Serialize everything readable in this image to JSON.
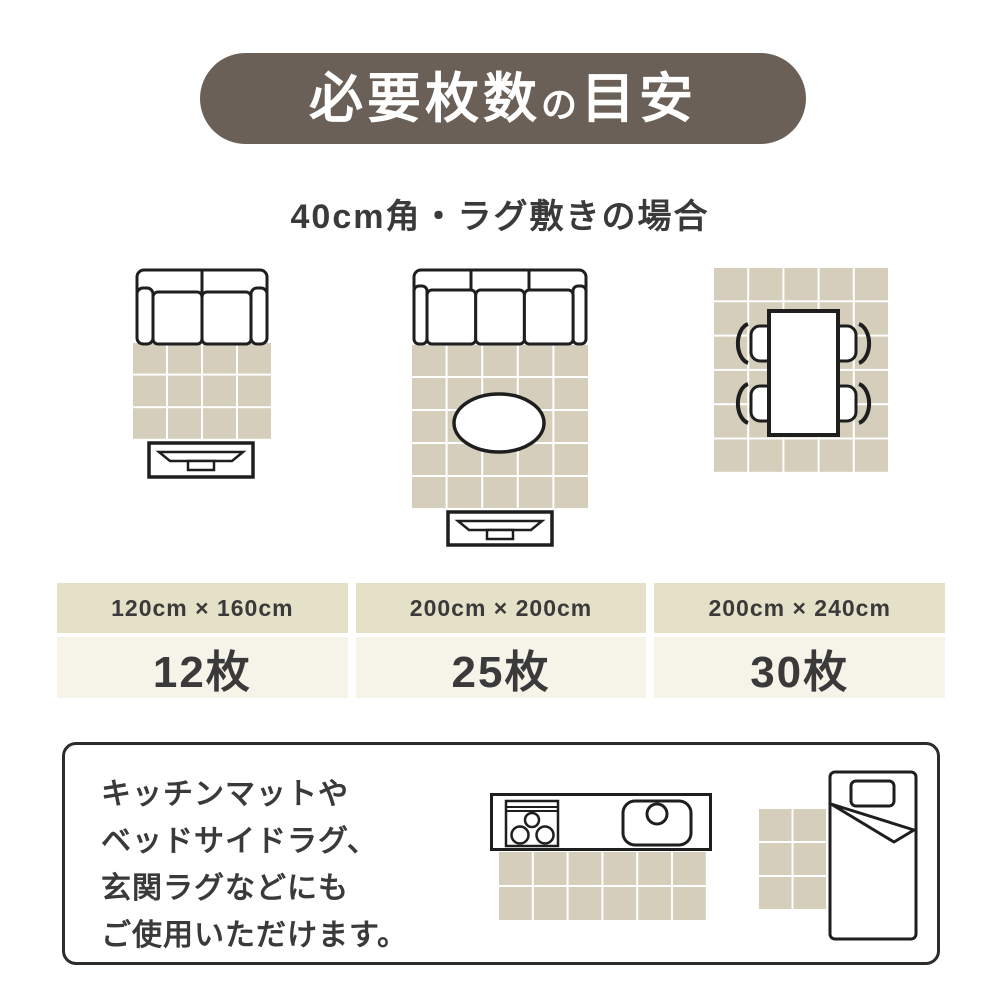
{
  "title": {
    "parts": [
      "必要枚数",
      "の",
      "目安"
    ]
  },
  "subtitle": "40cm角・ラグ敷きの場合",
  "colors": {
    "pill_bg": "#6a6057",
    "pill_text": "#ffffff",
    "tile": "#d5cebb",
    "size_header_bg": "#e5e1c8",
    "count_bg": "#f6f4e8",
    "ink": "#3a3a3a",
    "line": "#1e1e1e"
  },
  "tile_spec": "40cm角",
  "layouts": [
    {
      "scene": "two-seat-sofa-with-tv-board",
      "size": "120cm × 160cm",
      "count": "12枚",
      "grid": {
        "cols": 4,
        "rows": 3
      }
    },
    {
      "scene": "three-seat-sofa-with-oval-table-and-tv-board",
      "size": "200cm × 200cm",
      "count": "25枚",
      "grid": {
        "cols": 5,
        "rows": 5
      }
    },
    {
      "scene": "dining-table-with-four-chairs",
      "size": "200cm × 240cm",
      "count": "30枚",
      "grid": {
        "cols": 5,
        "rows": 6
      }
    }
  ],
  "note": {
    "lines": [
      "キッチンマットや",
      "ベッドサイドラグ、",
      "玄関ラグなどにも",
      "ご使用いただけます。"
    ],
    "kitchen_mat_grid": {
      "cols": 6,
      "rows": 2
    },
    "bedside_rug_grid": {
      "cols": 2,
      "rows": 3
    }
  }
}
